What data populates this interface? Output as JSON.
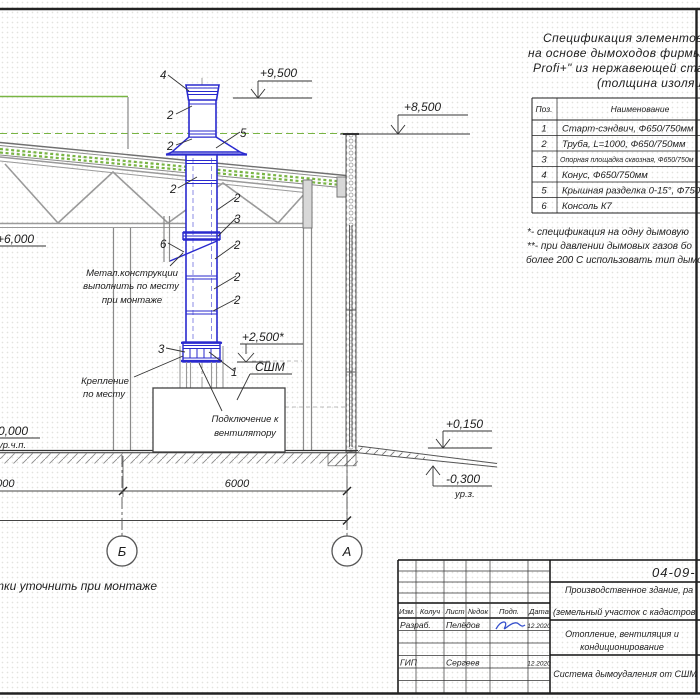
{
  "colors": {
    "chimney_blue": "#2a2ace",
    "roof_green": "#79b544",
    "line_dark": "#3a3a3a",
    "structure_gray": "#8a8a8a",
    "signature_blue": "#3550cc"
  },
  "spec": {
    "title_lines": [
      "Спецификация элементов си",
      "на основе дымоходов фирмы",
      "Profi+\" из нержавеющей ста",
      "(толщина изоляц"
    ],
    "table": {
      "headers": [
        "Поз.",
        "Наименование"
      ],
      "rows": [
        [
          "1",
          "Старт-сэндвич, Ф650/750мм"
        ],
        [
          "2",
          "Труба, L=1000, Ф650/750мм"
        ],
        [
          "3",
          "Опорная площадка сквозная, Ф650/750м"
        ],
        [
          "4",
          "Конус, Ф650/750мм"
        ],
        [
          "5",
          "Крышная разделка 0-15°, Ф750мм"
        ],
        [
          "6",
          "Консоль К7"
        ]
      ]
    },
    "notes": [
      "*- спецификация на одну дымовую",
      "**- при давлении дымовых газов бо",
      "более 200 С использовать тип дымо"
    ]
  },
  "drawing": {
    "elevations": {
      "e9500": "+9,500",
      "e8500": "+8,500",
      "e6000": "+6,000",
      "e0000": "0,000",
      "urchp": "ур.ч.п.",
      "e2500": "+2,500*",
      "e0150": "+0,150",
      "em0300": "-0,300",
      "urz": "ур.з.",
      "sshm": "СШМ"
    },
    "labels": {
      "metal1": "Метал.конструкции",
      "metal2": "выполнить по месту",
      "metal3": "при монтаже",
      "krep1": "Крепление",
      "krep2": "по месту",
      "podkl1": "Подключение к",
      "podkl2": "вентилятору",
      "note_bottom": "тки уточнить при монтаже"
    },
    "dims": {
      "d1": "6000",
      "d2": "6000"
    },
    "axes": {
      "b": "Б",
      "a": "А"
    },
    "items": [
      {
        "t": "4"
      },
      {
        "t": "2"
      },
      {
        "t": "2"
      },
      {
        "t": "5"
      },
      {
        "t": "2"
      },
      {
        "t": "2"
      },
      {
        "t": "3"
      },
      {
        "t": "6"
      },
      {
        "t": "2"
      },
      {
        "t": "2"
      },
      {
        "t": "2"
      },
      {
        "t": "3"
      },
      {
        "t": "1"
      }
    ]
  },
  "titleblock": {
    "doc_number": "04-09-",
    "project1": "Производственное здание, ра",
    "project2": "(земельный участок с кадастров",
    "section1": "Отопление, вентиляция и",
    "section2": "кондиционирование",
    "sheet_title": "Система дымоудаления от СШМ",
    "cols": [
      "Изм.",
      "Колуч",
      "Лист",
      "№док",
      "Подп.",
      "Дата"
    ],
    "rows": [
      {
        "role": "Разраб.",
        "name": "Пелёдов",
        "date": "12.2020"
      },
      {
        "role": "ГИП",
        "name": "Сергеев",
        "date": "12.2020"
      }
    ]
  }
}
